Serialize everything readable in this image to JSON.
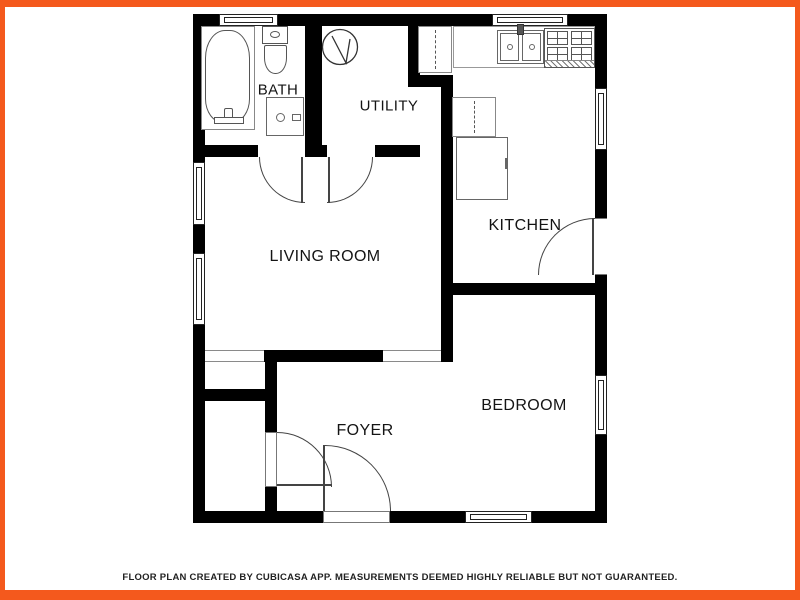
{
  "style": {
    "frame_color": "#F4591D",
    "wall_color": "#000000",
    "background": "#FFFFFF"
  },
  "rooms": {
    "bath": {
      "label": "BATH"
    },
    "utility": {
      "label": "UTILITY"
    },
    "living_room": {
      "label": "LIVING ROOM"
    },
    "kitchen": {
      "label": "KITCHEN"
    },
    "bedroom": {
      "label": "BEDROOM"
    },
    "foyer": {
      "label": "FOYER"
    }
  },
  "fixtures": [
    "bathtub-icon",
    "toilet-icon",
    "bathroom-sink-icon",
    "water-heater-icon",
    "upper-cabinet-icon",
    "kitchen-sink-icon",
    "stove-icon",
    "refrigerator-icon",
    "door-swing-icon",
    "window-icon"
  ],
  "footer": {
    "disclaimer": "FLOOR PLAN CREATED BY CUBICASA APP. MEASUREMENTS DEEMED HIGHLY RELIABLE BUT NOT GUARANTEED."
  }
}
